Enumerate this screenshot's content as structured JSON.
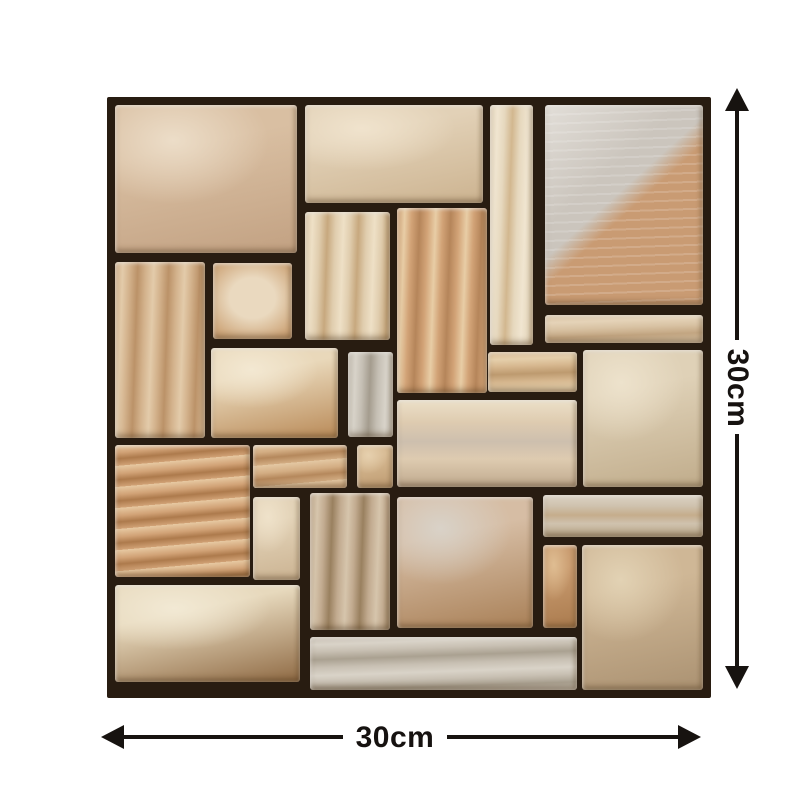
{
  "dimensions": {
    "width_label": "30cm",
    "height_label": "30cm"
  },
  "colors": {
    "background": "#ffffff",
    "grout": "#281c11",
    "arrow": "#171310",
    "label_text": "#161210"
  },
  "panel": {
    "x": 107,
    "y": 97,
    "w": 604,
    "h": 601
  },
  "stones": [
    {
      "id": "top-left-large",
      "x": 8,
      "y": 8,
      "w": 182,
      "h": 148,
      "t": "m",
      "c": [
        "#d9bfa2",
        "#ecddc8",
        "#c2a182"
      ]
    },
    {
      "id": "top-middle",
      "x": 198,
      "y": 8,
      "w": 178,
      "h": 98,
      "t": "m",
      "c": [
        "#e2d1b7",
        "#f0e3cd",
        "#ccb390"
      ]
    },
    {
      "id": "top-strip-vertical",
      "x": 383,
      "y": 8,
      "w": 43,
      "h": 240,
      "t": "v",
      "c": [
        "#e6d8be",
        "#f0e5d0",
        "#d2b78f"
      ]
    },
    {
      "id": "top-right-diagonal",
      "x": 438,
      "y": 8,
      "w": 158,
      "h": 200,
      "t": "diag",
      "c": [
        "#cbc5bd",
        "#c99b73",
        "#e2ded8"
      ]
    },
    {
      "id": "left-tall",
      "x": 8,
      "y": 165,
      "w": 90,
      "h": 176,
      "t": "v",
      "c": [
        "#d3b28c",
        "#e3cbaa",
        "#bb9268"
      ]
    },
    {
      "id": "small-square",
      "x": 106,
      "y": 166,
      "w": 79,
      "h": 76,
      "t": "core",
      "c": [
        "#cfa87d",
        "#ead9bf",
        "#c09468"
      ]
    },
    {
      "id": "mid-tall-cream",
      "x": 198,
      "y": 115,
      "w": 85,
      "h": 128,
      "t": "v",
      "c": [
        "#e0cdae",
        "#eee0c6",
        "#c7a87e"
      ]
    },
    {
      "id": "mid-tall-tan",
      "x": 290,
      "y": 111,
      "w": 90,
      "h": 185,
      "t": "v",
      "c": [
        "#d2a377",
        "#e8cda6",
        "#b5855a"
      ]
    },
    {
      "id": "right-thin-strip",
      "x": 438,
      "y": 218,
      "w": 158,
      "h": 28,
      "t": "h",
      "c": [
        "#d8c2a3",
        "#e5d3b8",
        "#c3a682"
      ]
    },
    {
      "id": "center-cream",
      "x": 104,
      "y": 251,
      "w": 127,
      "h": 90,
      "t": "m",
      "c": [
        "#e9d8ba",
        "#f3e8d2",
        "#b98a58"
      ]
    },
    {
      "id": "center-gray-strip",
      "x": 241,
      "y": 255,
      "w": 45,
      "h": 85,
      "t": "v",
      "c": [
        "#c5bfb4",
        "#d8d3c9",
        "#a49c8e"
      ]
    },
    {
      "id": "center-right-bar",
      "x": 381,
      "y": 255,
      "w": 89,
      "h": 40,
      "t": "h",
      "c": [
        "#d7b890",
        "#e5cfab",
        "#bd9a6f"
      ]
    },
    {
      "id": "right-big-square",
      "x": 476,
      "y": 253,
      "w": 120,
      "h": 137,
      "t": "m",
      "c": [
        "#dfd1b7",
        "#ede2cc",
        "#c0ac8b"
      ]
    },
    {
      "id": "left-orange-ridged",
      "x": 8,
      "y": 348,
      "w": 135,
      "h": 132,
      "t": "ridge",
      "c": [
        "#d1a276",
        "#e7c9a2",
        "#ad7a4c"
      ]
    },
    {
      "id": "mid-bar-tan",
      "x": 146,
      "y": 348,
      "w": 94,
      "h": 43,
      "t": "ridge",
      "c": [
        "#d3ad83",
        "#e4c8a3",
        "#b5885c"
      ]
    },
    {
      "id": "mid-bar-small",
      "x": 250,
      "y": 348,
      "w": 36,
      "h": 43,
      "t": "m",
      "c": [
        "#d7ba93",
        "#e6d0ae",
        "#bd9a70"
      ]
    },
    {
      "id": "center-wide-banded",
      "x": 290,
      "y": 303,
      "w": 180,
      "h": 87,
      "t": "band",
      "c": [
        "#decbb0",
        "#ece0c8",
        "#bfa98e",
        "#cdbfae"
      ]
    },
    {
      "id": "lower-cream-strip",
      "x": 146,
      "y": 400,
      "w": 47,
      "h": 83,
      "t": "m",
      "c": [
        "#e3d3b8",
        "#efe2ca",
        "#cbb392"
      ]
    },
    {
      "id": "lower-gray-tall",
      "x": 203,
      "y": 396,
      "w": 80,
      "h": 137,
      "t": "v",
      "c": [
        "#c2ab90",
        "#d6c5ac",
        "#99805f"
      ]
    },
    {
      "id": "lower-center-large",
      "x": 290,
      "y": 400,
      "w": 136,
      "h": 131,
      "t": "m",
      "c": [
        "#d6bda4",
        "#d9d2c8",
        "#a98057"
      ]
    },
    {
      "id": "lower-right-bar",
      "x": 436,
      "y": 398,
      "w": 160,
      "h": 42,
      "t": "band",
      "c": [
        "#cfc2ae",
        "#dcd3c4",
        "#b9a687",
        "#c5ad8c"
      ]
    },
    {
      "id": "lower-orange-narrow",
      "x": 436,
      "y": 448,
      "w": 34,
      "h": 83,
      "t": "m",
      "c": [
        "#c99b6f",
        "#dfbd92",
        "#aa7b4e"
      ]
    },
    {
      "id": "bottom-right-square",
      "x": 475,
      "y": 448,
      "w": 121,
      "h": 145,
      "t": "m",
      "c": [
        "#cfb796",
        "#e2d2b4",
        "#ab9272"
      ]
    },
    {
      "id": "bottom-left-large",
      "x": 8,
      "y": 488,
      "w": 185,
      "h": 97,
      "t": "m",
      "c": [
        "#e7d9bd",
        "#f2e9d4",
        "#8f6a44"
      ]
    },
    {
      "id": "bottom-wide-gray",
      "x": 203,
      "y": 540,
      "w": 267,
      "h": 53,
      "t": "h",
      "c": [
        "#c8c0b3",
        "#d9d3c8",
        "#aaa191"
      ]
    }
  ]
}
